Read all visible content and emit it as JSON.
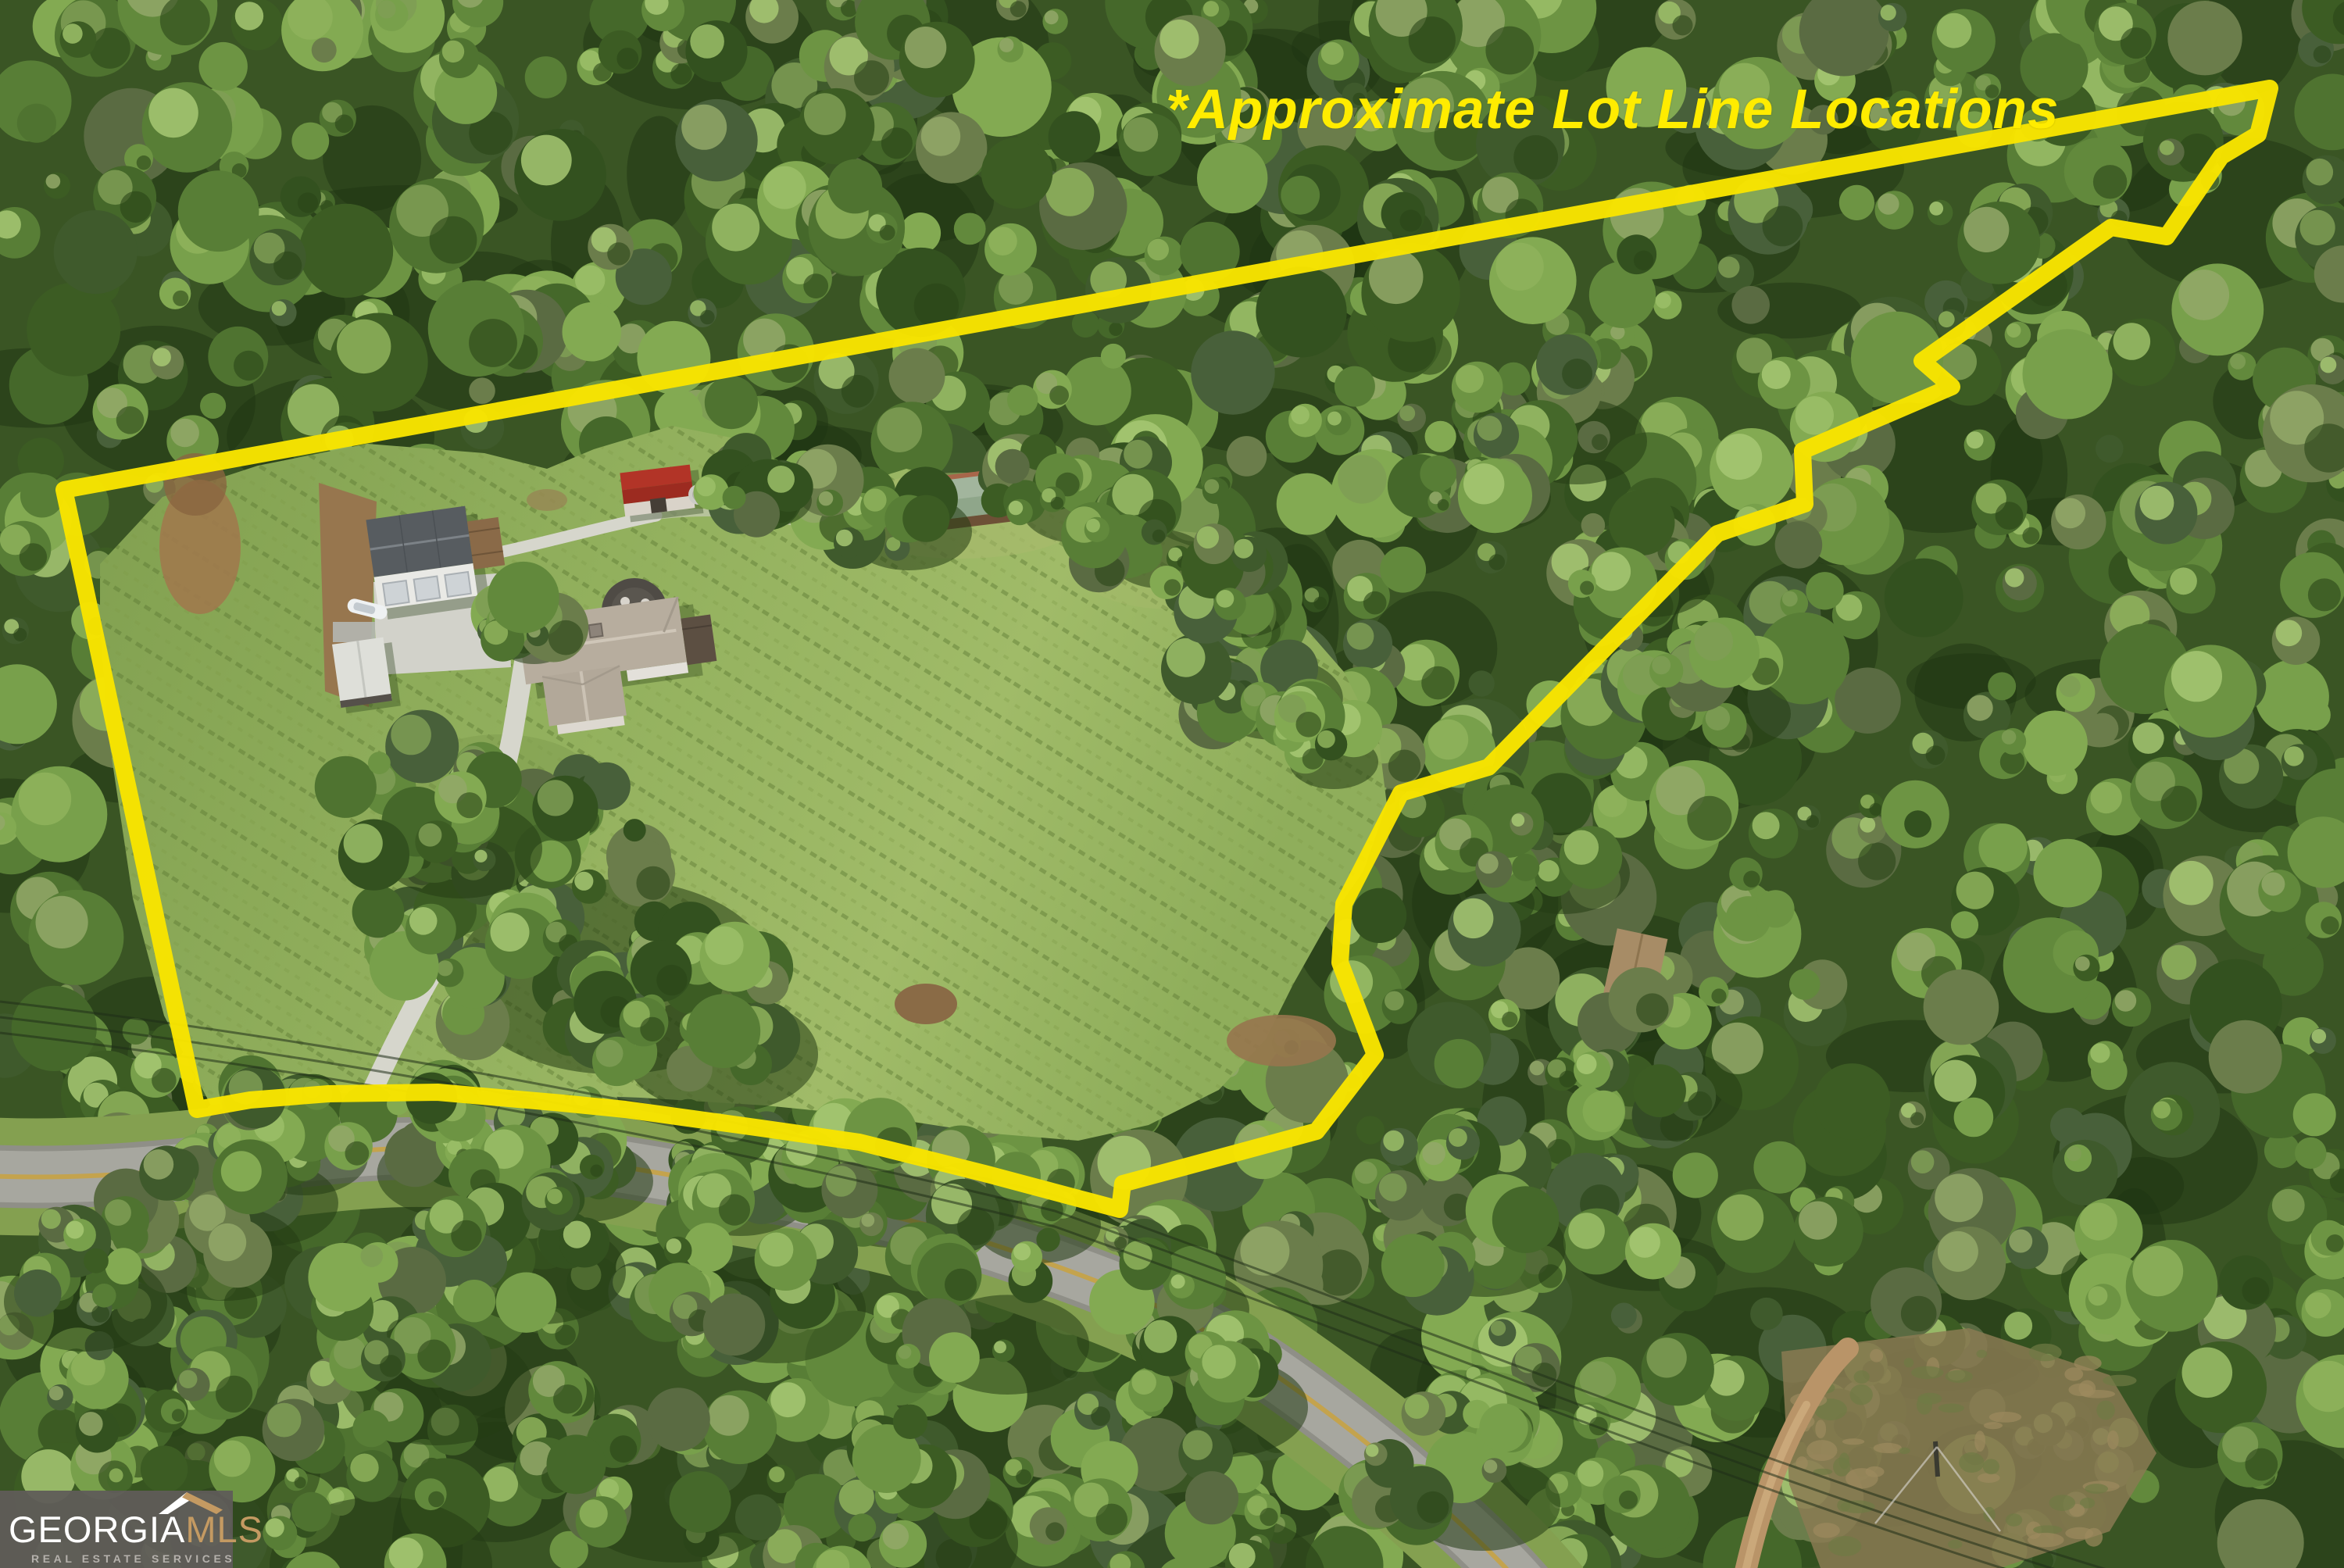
{
  "annotation": {
    "text": "*Approximate Lot Line Locations",
    "color": "#ffec00"
  },
  "logo": {
    "brand_primary": "GEORGIA",
    "brand_secondary": "MLS",
    "tagline": "REAL ESTATE SERVICES",
    "primary_color": "#ffffff",
    "secondary_color": "#c49a62",
    "tagline_color": "#b5b1ac",
    "background_color": "#5f5c58"
  },
  "lot_line": {
    "color": "#f8e400",
    "stroke_width": 22,
    "points": [
      [
        82,
        627
      ],
      [
        2905,
        113
      ],
      [
        2890,
        172
      ],
      [
        2843,
        200
      ],
      [
        2773,
        303
      ],
      [
        2702,
        291
      ],
      [
        2460,
        462
      ],
      [
        2498,
        495
      ],
      [
        2307,
        577
      ],
      [
        2310,
        645
      ],
      [
        2198,
        683
      ],
      [
        1905,
        982
      ],
      [
        1793,
        1015
      ],
      [
        1720,
        1157
      ],
      [
        1715,
        1232
      ],
      [
        1760,
        1350
      ],
      [
        1685,
        1448
      ],
      [
        1437,
        1515
      ],
      [
        1433,
        1548
      ],
      [
        1260,
        1502
      ],
      [
        1100,
        1462
      ],
      [
        967,
        1443
      ],
      [
        800,
        1420
      ],
      [
        720,
        1412
      ],
      [
        560,
        1398
      ],
      [
        420,
        1400
      ],
      [
        320,
        1408
      ],
      [
        252,
        1420
      ]
    ]
  },
  "colors": {
    "lot_line_yellow": "#f8e400",
    "annotation_yellow": "#ffec00",
    "logo_gold": "#c49a62",
    "forest_dark": "#33511f",
    "forest_light": "#83aa52",
    "lawn_green": "#93b15e",
    "road_gray": "#a7a79f",
    "dirt_brown": "#97764e",
    "concrete": "#d6d6cc",
    "red_roof": "#ae3124",
    "green_roof": "#a2b59d"
  }
}
